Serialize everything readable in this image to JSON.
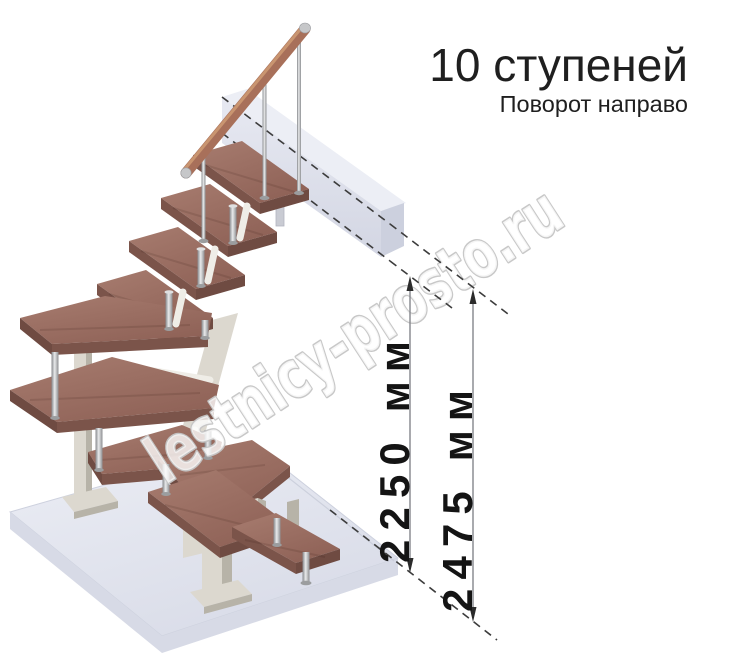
{
  "page": {
    "width": 744,
    "height": 655,
    "background": "#ffffff"
  },
  "header": {
    "title": "10 ступеней",
    "subtitle": "Поворот направо"
  },
  "dimensions": [
    {
      "label": "2250 мм"
    },
    {
      "label": "2475 мм"
    }
  ],
  "watermark": {
    "text": "lestnicy-prosto.ru"
  },
  "colors": {
    "page-bg": "#ffffff",
    "tread": "#9c7064",
    "tread-front": "#7b544a",
    "tread-side": "#6f4b42",
    "handrail": "#a8705a",
    "handrail-light": "#cf9b74",
    "metal": "#9b9d9f",
    "structure": "#dcd8cf",
    "structure-shadow": "#b7b3a8",
    "structure-arm": "#efede7",
    "floor-front": "#d7dae6",
    "slab-top": "#eceef5",
    "slab-end": "#ccd0de",
    "dash": "#3c3c3c",
    "dim-line": "#84868b",
    "arrow": "#2b2b2b",
    "label": "#141414",
    "title": "#1f1f1f",
    "watermark-stroke": "#c6c6c6"
  }
}
